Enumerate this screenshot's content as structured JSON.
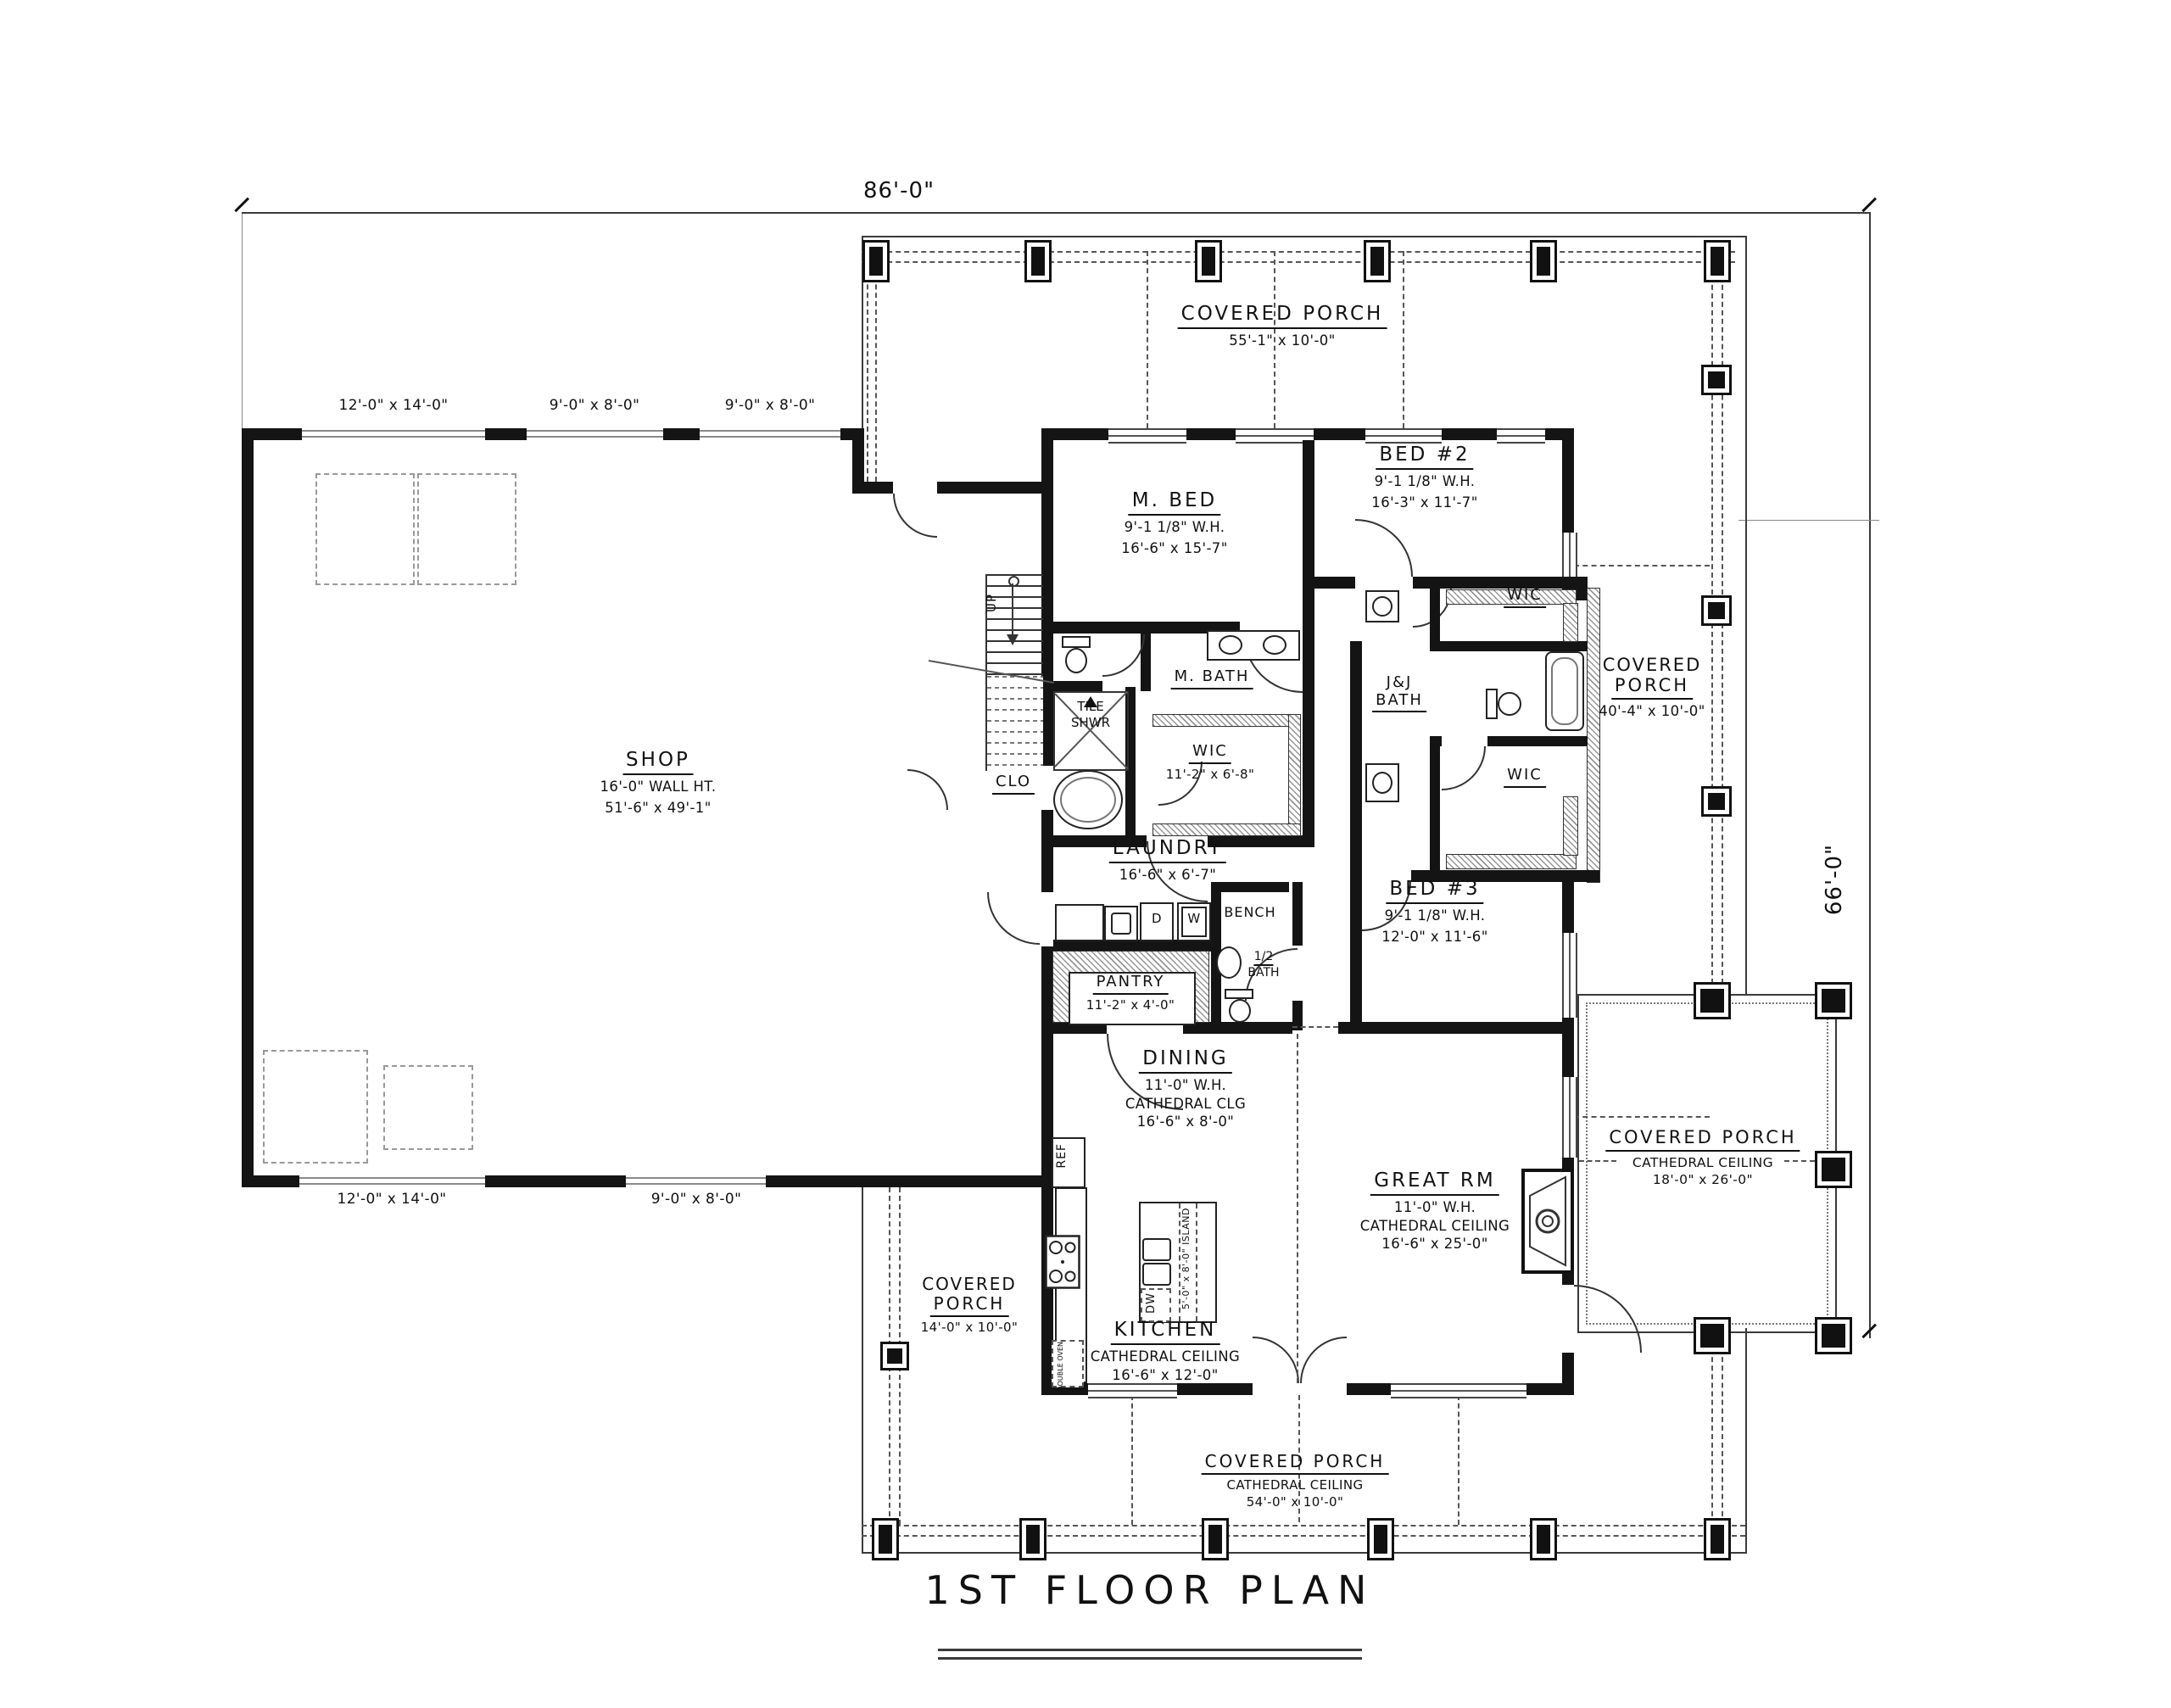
{
  "title": "1ST FLOOR PLAN",
  "dims": {
    "overall_width": "86'-0\"",
    "overall_height": "66'-0\""
  },
  "porches": {
    "top": {
      "name": "COVERED PORCH",
      "size": "55'-1\" x 10'-0\""
    },
    "right": {
      "name_line1": "COVERED",
      "name_line2": "PORCH",
      "size": "40'-4\" x 10'-0\""
    },
    "big_right": {
      "name": "COVERED PORCH",
      "ceiling": "CATHEDRAL CEILING",
      "size": "18'-0\" x 26'-0\""
    },
    "bottom": {
      "name": "COVERED PORCH",
      "ceiling": "CATHEDRAL CEILING",
      "size": "54'-0\" x 10'-0\""
    },
    "left": {
      "name_line1": "COVERED",
      "name_line2": "PORCH",
      "size": "14'-0\" x 10'-0\""
    }
  },
  "shop": {
    "name": "SHOP",
    "wall_height": "16'-0\" WALL HT.",
    "size": "51'-6\" x 49'-1\"",
    "doors_top": [
      "12'-0\" x 14'-0\"",
      "9'-0\" x 8'-0\"",
      "9'-0\" x 8'-0\""
    ],
    "doors_bottom": [
      "12'-0\" x 14'-0\"",
      "9'-0\" x 8'-0\""
    ]
  },
  "rooms": {
    "m_bed": {
      "name": "M. BED",
      "wh": "9'-1 1/8\" W.H.",
      "size": "16'-6\" x 15'-7\""
    },
    "bed2": {
      "name": "BED #2",
      "wh": "9'-1 1/8\" W.H.",
      "size": "16'-3\" x 11'-7\""
    },
    "bed3": {
      "name": "BED #3",
      "wh": "9'-1 1/8\" W.H.",
      "size": "12'-0\" x 11'-6\""
    },
    "m_bath": {
      "name": "M. BATH"
    },
    "tile_shwr": {
      "line1": "TILE",
      "line2": "SHWR"
    },
    "wic_master": {
      "name": "WIC",
      "size": "11'-2\" x 6'-8\""
    },
    "wic_bed2": {
      "name": "WIC"
    },
    "wic_bed3": {
      "name": "WIC"
    },
    "jj_bath": {
      "line1": "J&J",
      "line2": "BATH"
    },
    "clo": {
      "name": "CLO"
    },
    "up": "UP",
    "laundry": {
      "name": "LAUNDRY",
      "size": "16'-6\" x 6'-7\""
    },
    "bench": {
      "name": "BENCH"
    },
    "half_bath": {
      "line1": "1/2",
      "line2": "BATH"
    },
    "pantry": {
      "name": "PANTRY",
      "size": "11'-2\" x 4'-0\""
    },
    "dining": {
      "name": "DINING",
      "wh": "11'-0\" W.H.",
      "ceiling": "CATHEDRAL CLG",
      "size": "16'-6\" x 8'-0\""
    },
    "great_rm": {
      "name": "GREAT RM",
      "wh": "11'-0\" W.H.",
      "ceiling": "CATHEDRAL CEILING",
      "size": "16'-6\" x 25'-0\""
    },
    "kitchen": {
      "name": "KITCHEN",
      "ceiling": "CATHEDRAL CEILING",
      "size": "16'-6\" x 12'-0\""
    }
  },
  "fixtures": {
    "ref": "REF",
    "dw": "DW",
    "washer": "W",
    "dryer": "D",
    "double_oven": "DOUBLE OVEN",
    "island": "5'-0\" x 8'-0\" ISLAND"
  }
}
